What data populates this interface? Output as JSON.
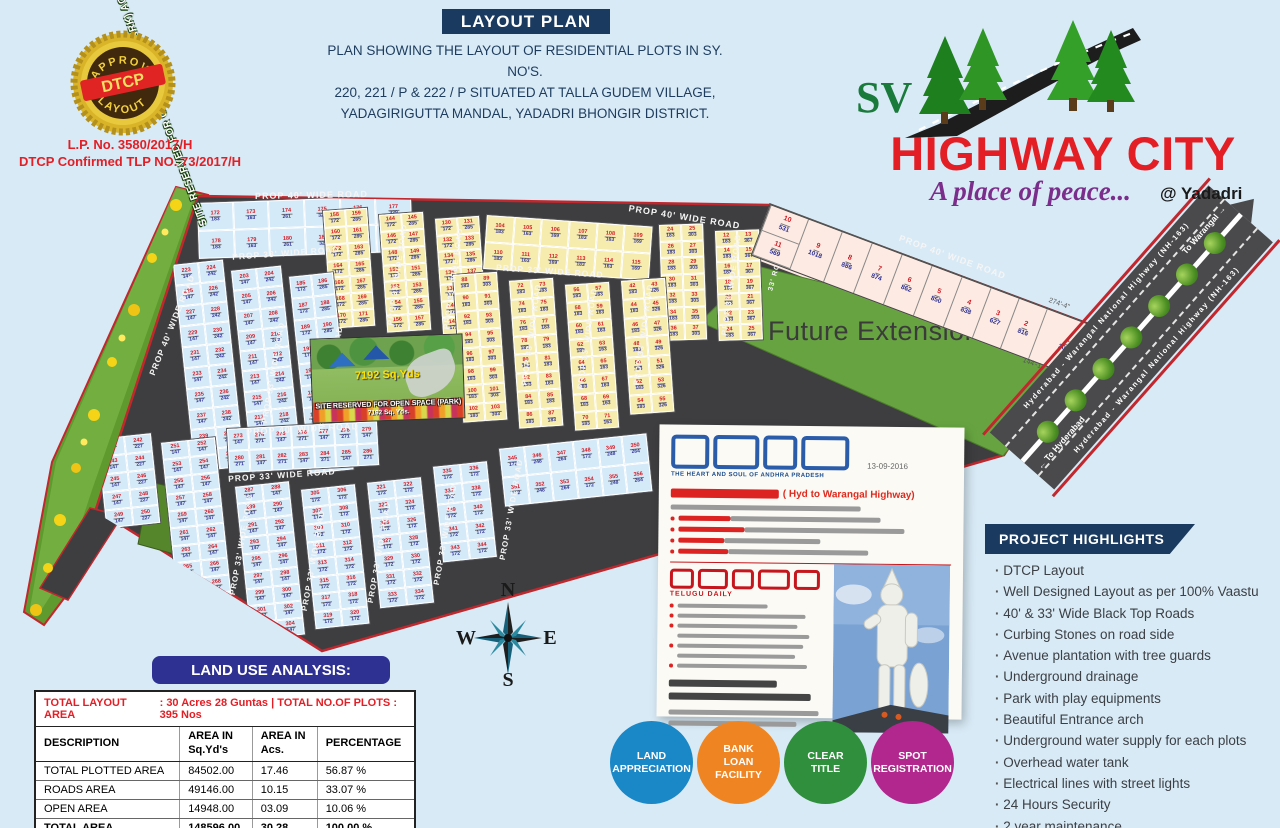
{
  "header": {
    "banner": "LAYOUT PLAN",
    "desc_line1": "PLAN SHOWING THE LAYOUT OF RESIDENTIAL PLOTS IN SY. NO'S.",
    "desc_line2": "220, 221 / P & 222 / P SITUATED AT TALLA GUDEM VILLAGE,",
    "desc_line3": "YADAGIRIGUTTA MANDAL, YADADRI BHONGIR DISTRICT.",
    "badge": {
      "top": "APPROVED",
      "center": "DTCP",
      "bottom": "LAYOUT"
    },
    "lp_line1": "L.P. No. 3580/2017/H",
    "lp_line2": "DTCP Confirmed TLP NO. 73/2017/H"
  },
  "logo": {
    "sv": "SV",
    "name": "HIGHWAY CITY",
    "tagline": "A place of peace...",
    "location": "@ Yadadri"
  },
  "map": {
    "green_strip_label": "SITE RESERVED FOR OPEN SPACE (PARK) AC 1.64 Cents",
    "future_extension": "Future Extension",
    "park": {
      "line1": "7192 Sq.Yds",
      "line2": "SITE RESERVED FOR OPEN SPACE (PARK)",
      "line3": "7192 Sq. Yds."
    },
    "compass": {
      "n": "N",
      "w": "W",
      "e": "E",
      "s": "S"
    },
    "dims": [
      {
        "t": "274'-4\"",
        "x": 1050,
        "y": 297,
        "r": 20
      },
      {
        "t": "144'-11\"",
        "x": 1024,
        "y": 357,
        "r": 20
      }
    ],
    "road_labels": [
      {
        "t": "PROP 40' WIDE ROAD",
        "x": 255,
        "y": 190,
        "r": -1,
        "s": 9
      },
      {
        "t": "PROP 40' WIDE ROAD",
        "x": 628,
        "y": 212,
        "r": 9,
        "s": 9
      },
      {
        "t": "PROP 40' WIDE ROAD",
        "x": 896,
        "y": 252,
        "r": 20,
        "s": 9
      },
      {
        "t": "PROP 33' WIDE ROAD",
        "x": 232,
        "y": 248,
        "r": -4,
        "s": 8.5
      },
      {
        "t": "PROP 33' WIDE ROAD",
        "x": 496,
        "y": 266,
        "r": 4,
        "s": 8.5
      },
      {
        "t": "PROP 40' WIDE ROAD",
        "x": 118,
        "y": 320,
        "r": -68,
        "s": 8.5
      },
      {
        "t": "PROP 33' WIDE ROAD",
        "x": 222,
        "y": 368,
        "r": -80,
        "s": 8
      },
      {
        "t": "PROP 33' WIDE ROAD",
        "x": 280,
        "y": 372,
        "r": -80,
        "s": 8
      },
      {
        "t": "PROP 33' WIDE ROAD",
        "x": 346,
        "y": 270,
        "r": -82,
        "s": 8
      },
      {
        "t": "PROP 33' WIDE ROAD",
        "x": 402,
        "y": 274,
        "r": -82,
        "s": 8
      },
      {
        "t": "PROP 33' WIDE ROAD",
        "x": 480,
        "y": 330,
        "r": -82,
        "s": 8
      },
      {
        "t": "PROP 33' WIDE ROAD",
        "x": 536,
        "y": 334,
        "r": -82,
        "s": 8
      },
      {
        "t": "PROP 33' WIDE ROAD",
        "x": 592,
        "y": 330,
        "r": -82,
        "s": 8
      },
      {
        "t": "PROP 33' WIDE ROAD",
        "x": 680,
        "y": 280,
        "r": -82,
        "s": 8
      },
      {
        "t": "33' ROAD",
        "x": 756,
        "y": 268,
        "r": -75,
        "s": 7
      },
      {
        "t": "PROP 40' WIDE ROAD",
        "x": 246,
        "y": 424,
        "r": -3,
        "s": 9
      },
      {
        "t": "PROP 33' WIDE ROAD",
        "x": 228,
        "y": 470,
        "r": -4,
        "s": 8.5
      },
      {
        "t": "PROP 33' WIDE ROAD",
        "x": 190,
        "y": 540,
        "r": -80,
        "s": 8
      },
      {
        "t": "PROP 33' WIDE ROAD",
        "x": 262,
        "y": 556,
        "r": -80,
        "s": 8
      },
      {
        "t": "PROP 33' WIDE ROAD",
        "x": 328,
        "y": 548,
        "r": -80,
        "s": 8
      },
      {
        "t": "PROP 33' WIDE ROAD",
        "x": 394,
        "y": 530,
        "r": -80,
        "s": 8
      },
      {
        "t": "PROP 33' WIDE ROAD",
        "x": 460,
        "y": 505,
        "r": -80,
        "s": 8
      }
    ],
    "blocks": [
      {
        "x": 196,
        "y": 202,
        "w": 216,
        "h": 58,
        "rot": -2,
        "kind": "blue",
        "cols": 6,
        "rows": 2,
        "start": 172,
        "areas": [
          "183",
          "163",
          "261",
          "321",
          "333",
          "339"
        ]
      },
      {
        "x": 322,
        "y": 210,
        "w": 46,
        "h": 120,
        "rot": -4,
        "kind": "yellow",
        "cols": 2,
        "rows": 7,
        "start": 158,
        "areas": [
          "172",
          "285"
        ]
      },
      {
        "x": 378,
        "y": 214,
        "w": 46,
        "h": 120,
        "rot": -4,
        "kind": "yellow",
        "cols": 2,
        "rows": 7,
        "start": 144,
        "areas": [
          "172",
          "285"
        ]
      },
      {
        "x": 434,
        "y": 218,
        "w": 46,
        "h": 118,
        "rot": -4,
        "kind": "yellow",
        "cols": 2,
        "rows": 7,
        "start": 130,
        "areas": [
          "172",
          "285"
        ]
      },
      {
        "x": 486,
        "y": 214,
        "w": 168,
        "h": 56,
        "rot": 4,
        "kind": "yellow",
        "cols": 6,
        "rows": 2,
        "start": 104,
        "areas": [
          "183",
          "163",
          "169"
        ]
      },
      {
        "x": 658,
        "y": 224,
        "w": 46,
        "h": 118,
        "rot": -2,
        "kind": "yellow",
        "cols": 2,
        "rows": 7,
        "start": 24,
        "areas": [
          "183",
          "303"
        ]
      },
      {
        "x": 714,
        "y": 230,
        "w": 46,
        "h": 112,
        "rot": -2,
        "kind": "yellow",
        "cols": 2,
        "rows": 7,
        "start": 12,
        "areas": [
          "183",
          "367"
        ]
      },
      {
        "x": 172,
        "y": 264,
        "w": 52,
        "h": 210,
        "rot": -6,
        "kind": "blue",
        "cols": 2,
        "rows": 10,
        "start": 223,
        "areas": [
          "147",
          "242"
        ]
      },
      {
        "x": 230,
        "y": 270,
        "w": 52,
        "h": 205,
        "rot": -6,
        "kind": "blue",
        "cols": 2,
        "rows": 10,
        "start": 203,
        "areas": [
          "147",
          "242"
        ]
      },
      {
        "x": 288,
        "y": 276,
        "w": 46,
        "h": 200,
        "rot": -6,
        "kind": "blue",
        "cols": 2,
        "rows": 9,
        "start": 185,
        "areas": [
          "172",
          "285"
        ]
      },
      {
        "x": 452,
        "y": 274,
        "w": 46,
        "h": 150,
        "rot": -4,
        "kind": "yellow",
        "cols": 2,
        "rows": 8,
        "start": 88,
        "areas": [
          "183",
          "303"
        ]
      },
      {
        "x": 508,
        "y": 280,
        "w": 46,
        "h": 150,
        "rot": -4,
        "kind": "yellow",
        "cols": 2,
        "rows": 8,
        "start": 72,
        "areas": [
          "183"
        ]
      },
      {
        "x": 564,
        "y": 284,
        "w": 46,
        "h": 148,
        "rot": -4,
        "kind": "yellow",
        "cols": 2,
        "rows": 8,
        "start": 56,
        "areas": [
          "183",
          "163"
        ]
      },
      {
        "x": 620,
        "y": 280,
        "w": 46,
        "h": 136,
        "rot": -4,
        "kind": "yellow",
        "cols": 2,
        "rows": 7,
        "start": 42,
        "areas": [
          "183",
          "326"
        ]
      },
      {
        "x": 96,
        "y": 438,
        "w": 56,
        "h": 92,
        "rot": -6,
        "kind": "blue",
        "cols": 2,
        "rows": 5,
        "start": 241,
        "areas": [
          "147",
          "227"
        ]
      },
      {
        "x": 160,
        "y": 442,
        "w": 56,
        "h": 192,
        "rot": -6,
        "kind": "blue",
        "cols": 2,
        "rows": 11,
        "start": 251,
        "areas": [
          "147"
        ]
      },
      {
        "x": 226,
        "y": 428,
        "w": 152,
        "h": 46,
        "rot": -3,
        "kind": "blue",
        "cols": 7,
        "rows": 2,
        "start": 273,
        "areas": [
          "147",
          "271"
        ]
      },
      {
        "x": 234,
        "y": 486,
        "w": 56,
        "h": 156,
        "rot": -6,
        "kind": "blue",
        "cols": 2,
        "rows": 9,
        "start": 287,
        "areas": [
          "147"
        ]
      },
      {
        "x": 300,
        "y": 489,
        "w": 56,
        "h": 142,
        "rot": -6,
        "kind": "blue",
        "cols": 2,
        "rows": 8,
        "start": 305,
        "areas": [
          "172"
        ]
      },
      {
        "x": 366,
        "y": 482,
        "w": 56,
        "h": 128,
        "rot": -6,
        "kind": "blue",
        "cols": 2,
        "rows": 7,
        "start": 321,
        "areas": [
          "172"
        ]
      },
      {
        "x": 432,
        "y": 466,
        "w": 56,
        "h": 98,
        "rot": -6,
        "kind": "blue",
        "cols": 2,
        "rows": 5,
        "start": 335,
        "areas": [
          "172"
        ]
      },
      {
        "x": 498,
        "y": 448,
        "w": 150,
        "h": 60,
        "rot": -6,
        "kind": "blue",
        "cols": 6,
        "rows": 2,
        "start": 345,
        "areas": [
          "172",
          "248",
          "264"
        ]
      }
    ],
    "pink_plots": [
      {
        "n": "10",
        "a": "531"
      },
      {
        "n": "11",
        "a": "569"
      },
      {
        "n": "9",
        "a": "1018"
      },
      {
        "n": "8",
        "a": "886"
      },
      {
        "n": "7",
        "a": "874"
      },
      {
        "n": "6",
        "a": "862"
      },
      {
        "n": "5",
        "a": "850"
      },
      {
        "n": "4",
        "a": "838"
      },
      {
        "n": "3",
        "a": "627"
      },
      {
        "n": "2",
        "a": "816"
      },
      {
        "n": "1",
        "a": "2045"
      }
    ]
  },
  "highway": {
    "name": "Hyderabad - Warangal National Highway (NH-163)",
    "to_right": "To Warangal →",
    "to_left": "← To Hyderabad"
  },
  "newspaper": {
    "date": "13-09-2016",
    "masthead1_script": "ఈనాడు",
    "masthead1_tagline": "THE HEART AND SOUL OF ANDHRA PRADESH",
    "headline_telugu": "పారిశ్రామిక కారిడార్",
    "headline_en": "( Hyd to Warangal Highway)",
    "subhead_telugu": "నాలుగు క్లస్టర్లుగా అభివృద్ధి.. కేంద్రం గ్రీన్ సిగ్నల్",
    "masthead2_script": "ఆంధ్రజ్యోతి",
    "masthead2_tagline": "TELUGU DAILY",
    "bold_caption_telugu": "గుట్టపై 100 అడుగుల ఆంజనేయ విగ్రహం ఏర్పాటుకు కసరత్తు",
    "footer_telugu": "యాదగిరి గుట్టపై కనువిందుచేసే క్షేత్ర పాలకుడు.. గాలులను తప్పుకునే వాయుపుత్రుడు.."
  },
  "land_use": {
    "banner": "LAND USE ANALYSIS:",
    "total_left": "TOTAL LAYOUT AREA",
    "total_right": ": 30 Acres 28 Guntas | TOTAL NO.OF PLOTS : 395 Nos",
    "headers": [
      {
        "t": "DESCRIPTION",
        "b": ""
      },
      {
        "t": "AREA IN",
        "b": "Sq.Yd's"
      },
      {
        "t": "AREA IN",
        "b": "Acs."
      },
      {
        "t": "PERCENTAGE",
        "b": ""
      }
    ],
    "rows": [
      [
        "TOTAL PLOTTED AREA",
        "84502.00",
        "17.46",
        "56.87 %"
      ],
      [
        "ROADS  AREA",
        "49146.00",
        "10.15",
        "33.07 %"
      ],
      [
        "OPEN  AREA",
        "14948.00",
        "03.09",
        "10.06 %"
      ],
      [
        "TOTAL  AREA",
        "148596.00",
        "30.28",
        "100.00 %"
      ]
    ]
  },
  "feature_circles": [
    {
      "lines": [
        "LAND",
        "APPRECIATION"
      ],
      "color": "#1a87c6"
    },
    {
      "lines": [
        "BANK",
        "LOAN",
        "FACILITY"
      ],
      "color": "#ef8522"
    },
    {
      "lines": [
        "CLEAR",
        "TITLE"
      ],
      "color": "#2f8f3c"
    },
    {
      "lines": [
        "SPOT",
        "REGISTRATION"
      ],
      "color": "#b1278e"
    }
  ],
  "highlights": {
    "title": "PROJECT HIGHLIGHTS",
    "items": [
      "DTCP Layout",
      "Well Designed Layout as per 100% Vaastu",
      "40' & 33' Wide Black Top Roads",
      "Curbing Stones on road side",
      "Avenue plantation with tree guards",
      "Underground drainage",
      "Park with play equipments",
      "Beautiful Entrance arch",
      "Underground water supply for each plots",
      "Overhead water tank",
      "Electrical lines with street lights",
      "24 Hours Security",
      "2 year maintenance"
    ]
  }
}
